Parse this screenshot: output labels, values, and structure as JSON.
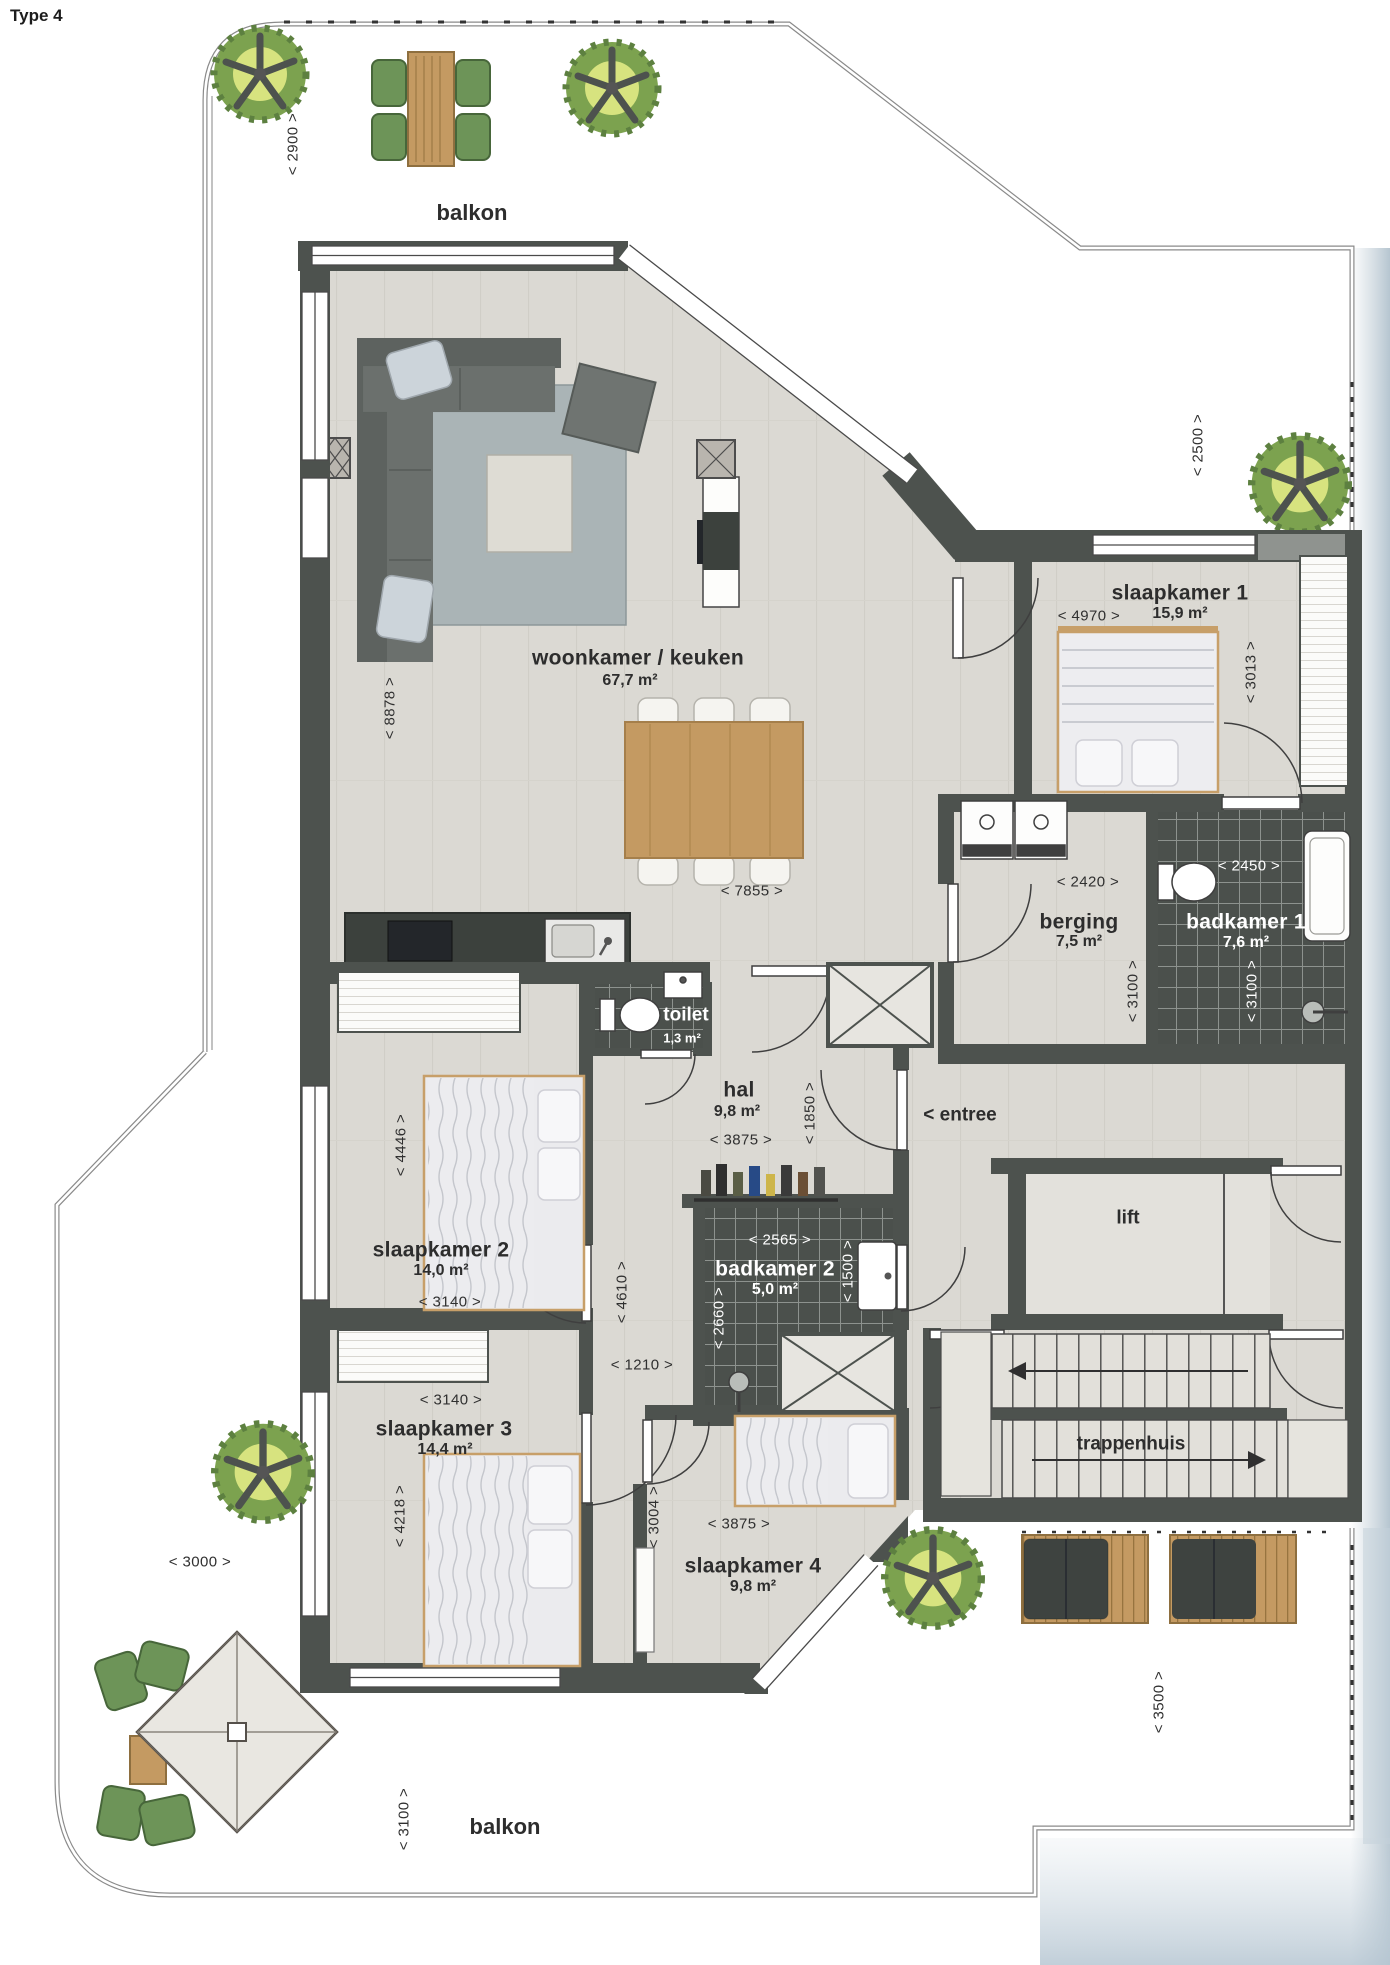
{
  "title": "Type 4",
  "balcony": {
    "top_label": "balkon",
    "bottom_label": "balkon"
  },
  "rooms": {
    "woonkamer": {
      "label": "woonkamer / keuken",
      "area": "67,7 m²"
    },
    "slaapkamer1": {
      "label": "slaapkamer 1",
      "area": "15,9 m²"
    },
    "slaapkamer2": {
      "label": "slaapkamer 2",
      "area": "14,0 m²"
    },
    "slaapkamer3": {
      "label": "slaapkamer 3",
      "area": "14,4 m²"
    },
    "slaapkamer4": {
      "label": "slaapkamer 4",
      "area": "9,8 m²"
    },
    "badkamer1": {
      "label": "badkamer 1",
      "area": "7,6 m²"
    },
    "badkamer2": {
      "label": "badkamer 2",
      "area": "5,0 m²"
    },
    "berging": {
      "label": "berging",
      "area": "7,5 m²"
    },
    "toilet": {
      "label": "toilet",
      "area": "1,3 m²"
    },
    "hal": {
      "label": "hal",
      "area": "9,8 m²"
    },
    "entree": {
      "label": "< entree"
    },
    "lift": {
      "label": "lift"
    },
    "trappenhuis": {
      "label": "trappenhuis"
    }
  },
  "dims": {
    "d2900": "< 2900 >",
    "d2500": "< 2500 >",
    "d8878": "< 8878 >",
    "d7855": "< 7855 >",
    "d4970": "< 4970 >",
    "d3013": "< 3013 >",
    "d2420": "< 2420 >",
    "d3100_berging": "< 3100 >",
    "d2450": "< 2450 >",
    "d3100_badkamer1": "< 3100 >",
    "d3875_hal": "< 3875 >",
    "d1850": "< 1850 >",
    "d3140_sl2": "< 3140 >",
    "d4446": "< 4446 >",
    "d4610": "< 4610 >",
    "d1210": "< 1210 >",
    "d2565": "< 2565 >",
    "d1500": "< 1500 >",
    "d2660": "< 2660 >",
    "d3140_sl3": "< 3140 >",
    "d4218": "< 4218 >",
    "d3875_sl4": "< 3875 >",
    "d3004": "< 3004 >",
    "d3000": "< 3000 >",
    "d3100_balkon": "< 3100 >",
    "d3500": "< 3500 >"
  },
  "colors": {
    "wall": "#4d524e",
    "floor": "#dbd9d3",
    "tile": "#4b504c",
    "wood": "#c49a62",
    "sofa": "#6b706d",
    "rug": "#aab4b6",
    "green": "#7ca24f",
    "scan_edge": "#b9c7d1"
  }
}
